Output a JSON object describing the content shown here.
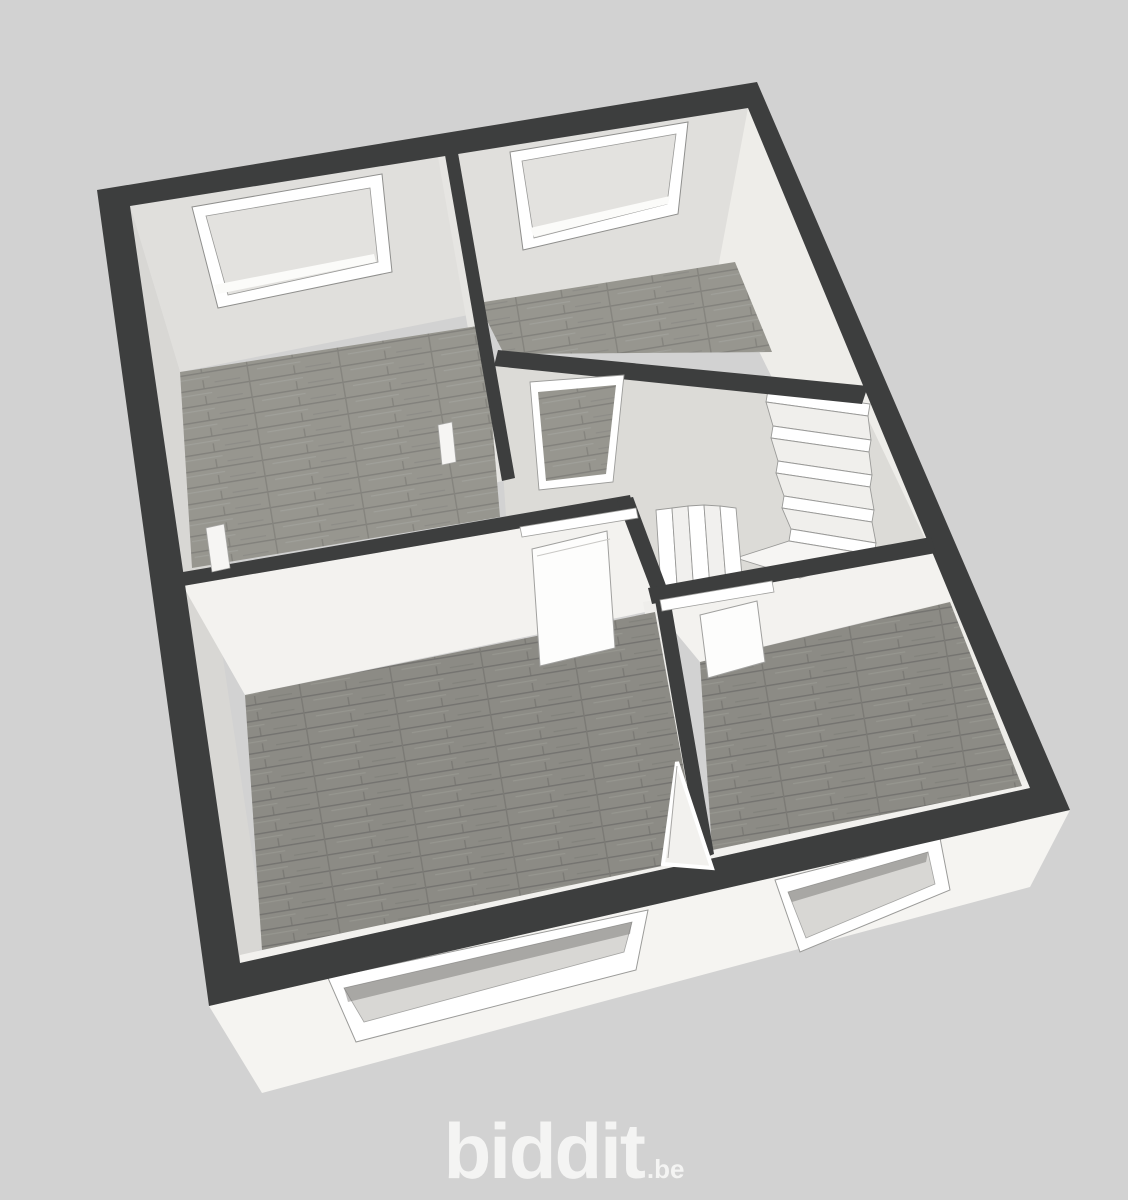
{
  "page": {
    "background_color": "#d2d2d2"
  },
  "logo": {
    "text": "biddit",
    "tld": ".be",
    "color": "#f4f4f3"
  },
  "floorplan": {
    "kind": "3d-rendered upper-floor plan, viewed from above at an angle",
    "colors": {
      "wall_top": "#3d3e3e",
      "interior_wall_face_light": "#f3f2ef",
      "interior_wall_face_shaded": "#e0dfdc",
      "facade": "#f5f4f1",
      "floor_wood_light": "#97968f",
      "floor_wood_dark": "#8c8b85",
      "hall_floor": "#dcdbd7",
      "window_frame": "#ffffff",
      "stairs": "#ffffff"
    },
    "rooms": [
      {
        "name": "room-top-left",
        "floor": "wood",
        "windows": 1
      },
      {
        "name": "room-top-center",
        "floor": "wood",
        "windows": 1
      },
      {
        "name": "hallway-landing",
        "floor": "plain"
      },
      {
        "name": "stairwell",
        "feature": "l-shaped-staircase-with-winders"
      },
      {
        "name": "room-bottom-left",
        "floor": "wood",
        "windows": 1
      },
      {
        "name": "room-bottom-right",
        "floor": "wood",
        "windows": 1
      }
    ],
    "window_count": 4,
    "door_count": 4,
    "staircase": "straight flight of 5 steps plus 5 winder steps turning left"
  }
}
